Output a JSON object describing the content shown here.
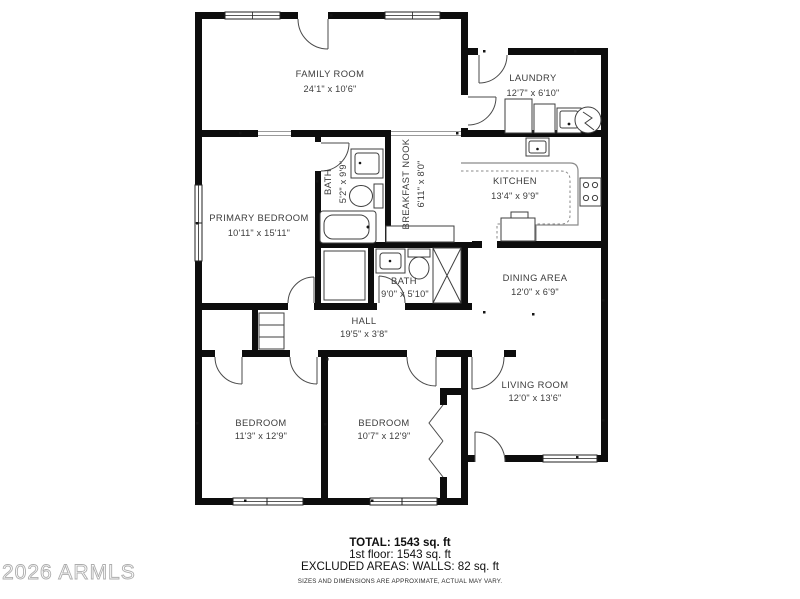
{
  "floor_plan": {
    "rooms": [
      {
        "id": "family-room",
        "name": "FAMILY ROOM",
        "dims": "24'1\" x 10'6\""
      },
      {
        "id": "laundry",
        "name": "LAUNDRY",
        "dims": "12'7\" x 6'10\""
      },
      {
        "id": "kitchen",
        "name": "KITCHEN",
        "dims": "13'4\" x 9'9\""
      },
      {
        "id": "breakfast-nook",
        "name": "BREAKFAST NOOK",
        "dims": "6'11\" x 8'0\""
      },
      {
        "id": "bath-upper",
        "name": "BATH",
        "dims": "5'2\" x 9'9\""
      },
      {
        "id": "primary-bedroom",
        "name": "PRIMARY BEDROOM",
        "dims": "10'11\" x 15'11\""
      },
      {
        "id": "bath-lower",
        "name": "BATH",
        "dims": "9'0\" x 5'10\""
      },
      {
        "id": "dining-area",
        "name": "DINING AREA",
        "dims": "12'0\" x 6'9\""
      },
      {
        "id": "hall",
        "name": "HALL",
        "dims": "19'5\" x 3'8\""
      },
      {
        "id": "living-room",
        "name": "LIVING ROOM",
        "dims": "12'0\" x 13'6\""
      },
      {
        "id": "bedroom-left",
        "name": "BEDROOM",
        "dims": "11'3\" x 12'9\""
      },
      {
        "id": "bedroom-right",
        "name": "BEDROOM",
        "dims": "10'7\" x 12'9\""
      }
    ]
  },
  "footer": {
    "total": "TOTAL: 1543 sq. ft",
    "first_floor": "1st floor: 1543 sq. ft",
    "excluded": "EXCLUDED AREAS: WALLS: 82 sq. ft",
    "disclaimer": "SIZES AND DIMENSIONS ARE APPROXIMATE, ACTUAL MAY VARY."
  },
  "watermark": "2026 ARMLS",
  "colors": {
    "wall": "#0d0d0d",
    "label": "#3c3c3c",
    "watermark": "#adadad"
  }
}
